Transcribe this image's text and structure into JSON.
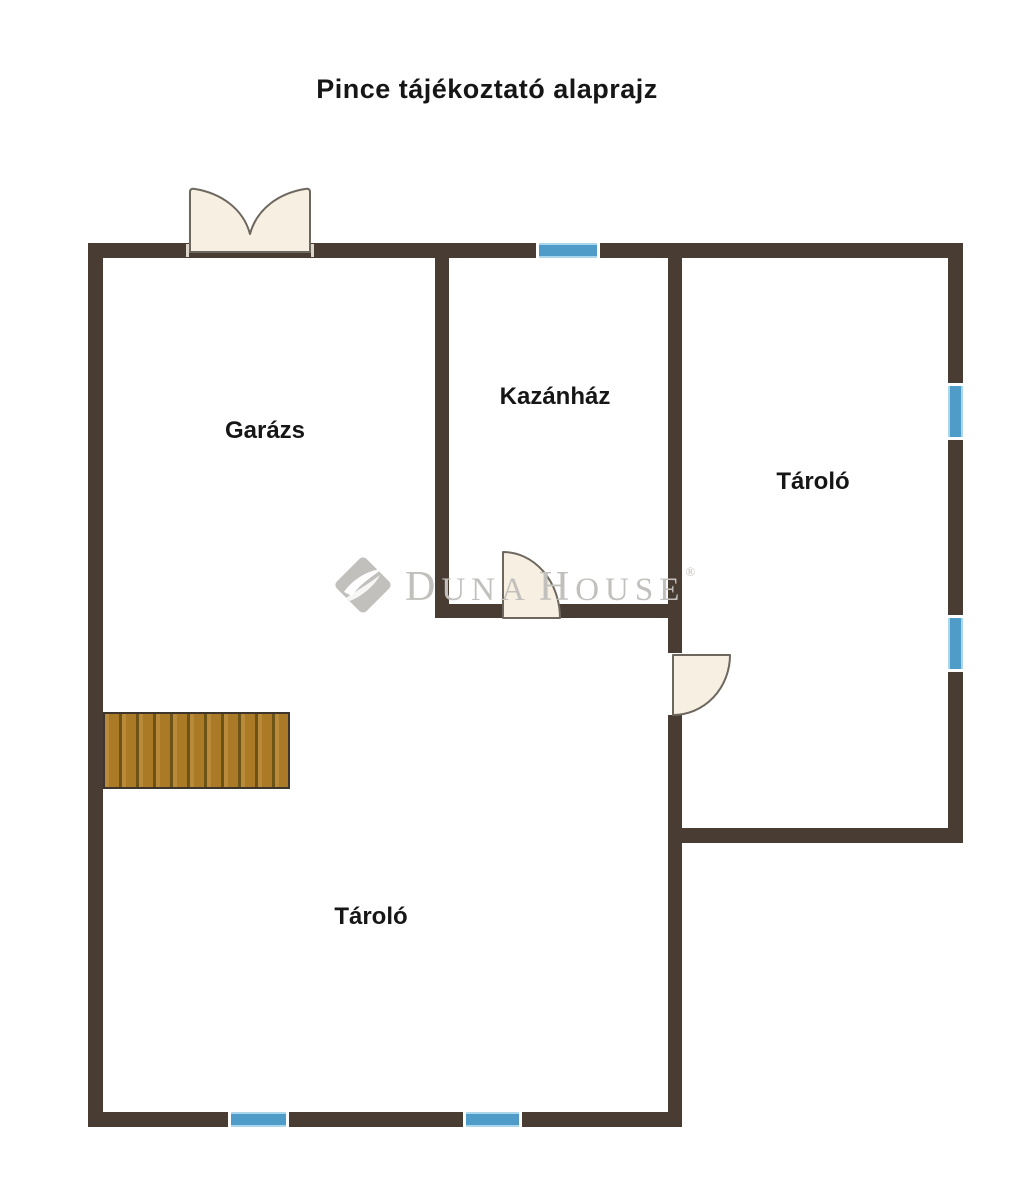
{
  "title": "Pince tájékoztató alaprajz",
  "rooms": [
    {
      "name": "garazs",
      "label": "Garázs"
    },
    {
      "name": "kazanhaz",
      "label": "Kazánház"
    },
    {
      "name": "tarolo_right",
      "label": "Tároló"
    },
    {
      "name": "tarolo_bottom",
      "label": "Tároló"
    }
  ],
  "watermark": {
    "logo_icon": "duna-house-diamond-icon",
    "part_d": "D",
    "part_una": "UNA",
    "part_h": "H",
    "part_ouse": "OUSE",
    "registered_mark": "®"
  },
  "colors": {
    "wall": "#493d33",
    "window": "#4e9cc7",
    "window_trim": "#aad7ec",
    "door_fill": "#f7f0e2",
    "door_outline": "#6e675f",
    "stairs_wood": "#aa7a27",
    "stairs_wood_light": "#b98a3a",
    "stairs_divider": "#6e5317",
    "stairs_border": "#3e362c",
    "watermark_gray": "#c2c0bd",
    "text": "#161616",
    "background": "#ffffff"
  }
}
